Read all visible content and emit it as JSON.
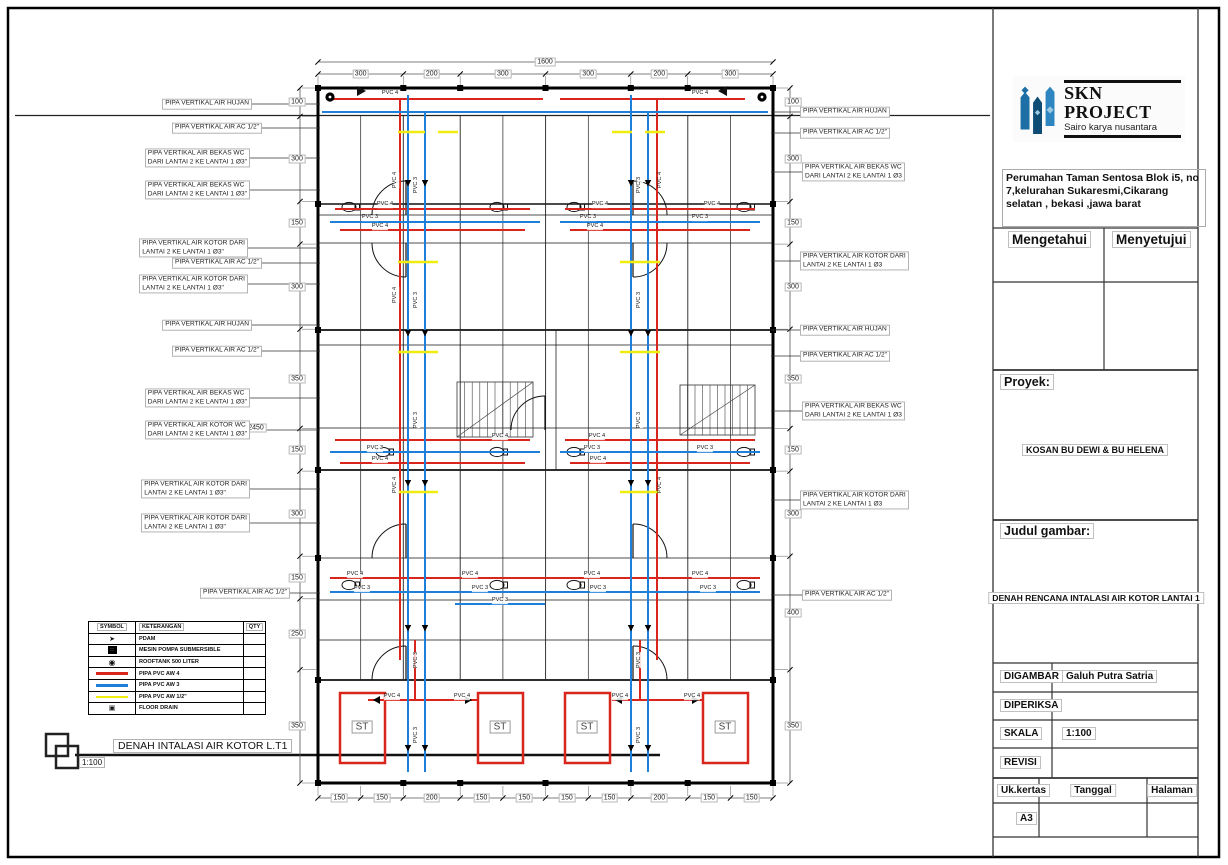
{
  "title_block": {
    "company": {
      "name": "SKN PROJECT",
      "tagline": "Sairo karya nusantara",
      "logo_color": "#1d6fa5"
    },
    "address": "Perumahan Taman Sentosa Blok i5, no 7,kelurahan Sukaresmi,Cikarang selatan , bekasi ,jawa barat",
    "approve_left": "Mengetahui",
    "approve_right": "Menyetujui",
    "proyek_label": "Proyek:",
    "proyek_value": "KOSAN BU DEWI & BU HELENA",
    "judul_label": "Judul gambar:",
    "judul_value": "DENAH RENCANA INTALASI AIR KOTOR LANTAI 1",
    "fields": [
      {
        "label": "DIGAMBAR",
        "value": "Galuh Putra Satria"
      },
      {
        "label": "DIPERIKSA",
        "value": ""
      },
      {
        "label": "SKALA",
        "value": "1:100"
      },
      {
        "label": "REVISI",
        "value": ""
      }
    ],
    "paper_label": "Uk.kertas",
    "date_label": "Tanggal",
    "page_label": "Halaman",
    "paper_size": "A3"
  },
  "drawing_title": {
    "text": "DENAH INTALASI AIR KOTOR L.T1",
    "scale": "1:100"
  },
  "legend": {
    "headers": [
      "SYMBOL",
      "KETERANGAN",
      "QTY"
    ],
    "rows": [
      {
        "symbol": "pdam-arrow",
        "label": "PDAM"
      },
      {
        "symbol": "submersible-pump",
        "label": "MESIN POMPA SUBMERSIBLE"
      },
      {
        "symbol": "rooftank",
        "label": "ROOFTANK 500 LITER"
      },
      {
        "symbol": "pipe-red",
        "label": "PIPA PVC AW 4"
      },
      {
        "symbol": "pipe-blue",
        "label": "PIPA PVC AW 3"
      },
      {
        "symbol": "pipe-yellow",
        "label": "PIPA PVC AW 1/2\""
      },
      {
        "symbol": "floor-drain",
        "label": "FLOOR DRAIN"
      }
    ]
  },
  "callouts_left": [
    {
      "lines": [
        "PIPA VERTIKAL AIR HUJAN"
      ]
    },
    {
      "lines": [
        "PIPA VERTIKAL AIR AC 1/2\""
      ]
    },
    {
      "lines": [
        "PIPA VERTIKAL AIR BEKAS WC",
        "DARI LANTAI 2 KE LANTAI 1 Ø3\""
      ]
    },
    {
      "lines": [
        "PIPA VERTIKAL AIR BEKAS WC",
        "DARI LANTAI 2 KE LANTAI 1 Ø3\""
      ]
    },
    {
      "lines": [
        "PIPA VERTIKAL AIR KOTOR DARI",
        "LANTAI 2 KE LANTAI 1 Ø3\""
      ]
    },
    {
      "lines": [
        "PIPA VERTIKAL AIR AC 1/2\""
      ]
    },
    {
      "lines": [
        "PIPA VERTIKAL AIR KOTOR DARI",
        "LANTAI 2 KE LANTAI 1 Ø3\""
      ]
    },
    {
      "lines": [
        "PIPA VERTIKAL AIR HUJAN"
      ]
    },
    {
      "lines": [
        "PIPA VERTIKAL AIR AC 1/2\""
      ]
    },
    {
      "lines": [
        "PIPA VERTIKAL AIR BEKAS WC",
        "DARI LANTAI 2 KE LANTAI 1 Ø3\""
      ]
    },
    {
      "lines": [
        "PIPA VERTIKAL AIR KOTOR WC",
        "DARI LANTAI 2 KE LANTAI 1 Ø3\""
      ]
    },
    {
      "lines": [
        "PIPA VERTIKAL AIR KOTOR DARI",
        "LANTAI 2 KE LANTAI 1 Ø3\""
      ]
    },
    {
      "lines": [
        "PIPA VERTIKAL AIR KOTOR DARI",
        "LANTAI 2 KE LANTAI 1 Ø3\""
      ]
    },
    {
      "lines": [
        "PIPA VERTIKAL AIR AC 1/2\""
      ]
    }
  ],
  "callouts_right": [
    {
      "lines": [
        "PIPA VERTIKAL AIR HUJAN"
      ]
    },
    {
      "lines": [
        "PIPA VERTIKAL AIR AC 1/2\""
      ]
    },
    {
      "lines": [
        "PIPA VERTIKAL AIR BEKAS WC",
        "DARI LANTAI 2 KE LANTAI 1 Ø3"
      ]
    },
    {
      "lines": [
        "PIPA VERTIKAL AIR KOTOR DARI",
        "LANTAI 2 KE LANTAI 1 Ø3"
      ]
    },
    {
      "lines": [
        "PIPA VERTIKAL AIR HUJAN"
      ]
    },
    {
      "lines": [
        "PIPA VERTIKAL AIR AC 1/2\""
      ]
    },
    {
      "lines": [
        "PIPA VERTIKAL AIR BEKAS WC",
        "DARI LANTAI 2 KE LANTAI 1 Ø3"
      ]
    },
    {
      "lines": [
        "PIPA VERTIKAL AIR KOTOR DARI",
        "LANTAI 2 KE LANTAI 1 Ø3"
      ]
    },
    {
      "lines": [
        "PIPA VERTIKAL AIR AC 1/2\""
      ]
    }
  ],
  "dimensions": {
    "top_total": "1600",
    "top": [
      "300",
      "200",
      "300",
      "300",
      "200",
      "300"
    ],
    "bottom": [
      "150",
      "150",
      "200",
      "150",
      "150",
      "150",
      "150",
      "200",
      "150",
      "150"
    ],
    "left": [
      "100",
      "300",
      "150",
      "300",
      "350",
      "150",
      "300",
      "150",
      "250",
      "350"
    ],
    "left_total": "2450",
    "right": [
      "100",
      "300",
      "150",
      "300",
      "350",
      "150",
      "300",
      "400",
      "350"
    ]
  },
  "plan": {
    "st_label": "ST",
    "pvc4": "PVC 4",
    "pvc3": "PVC 3",
    "colors": {
      "pipe_red": "#d9261c",
      "pipe_blue": "#1d7fd9",
      "pipe_yellow": "#f0ec10"
    }
  }
}
